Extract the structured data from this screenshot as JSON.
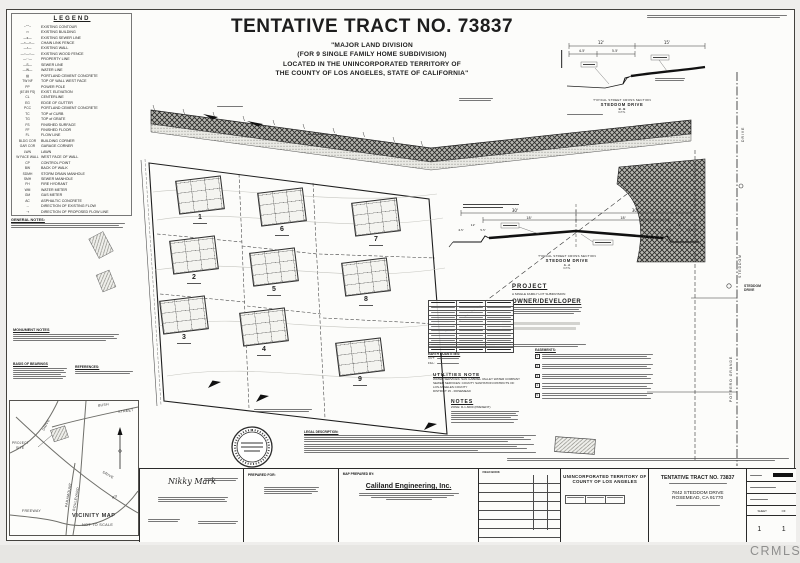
{
  "watermark": {
    "label": "CRMLS"
  },
  "header": {
    "title": "TENTATIVE TRACT NO. 73837",
    "sub1": "\"MAJOR LAND DIVISION",
    "sub2": "(FOR 9 SINGLE FAMILY HOME SUBDIVISION)",
    "sub3": "LOCATED IN THE UNINCORPORATED TERRITORY OF",
    "sub4": "THE COUNTY OF LOS ANGELES, STATE OF CALIFORNIA\""
  },
  "legend": {
    "heading": "LEGEND",
    "items": [
      {
        "sym": "~⌒~",
        "label": "EXISTING CONTOUR"
      },
      {
        "sym": "▭",
        "label": "EXISTING BUILDING"
      },
      {
        "sym": "—s—",
        "label": "EXISTING SEWER LINE"
      },
      {
        "sym": "—×—×—",
        "label": "CHAIN LINK FENCE"
      },
      {
        "sym": "—▪—",
        "label": "EXISTING WALL"
      },
      {
        "sym": "—○—○—",
        "label": "EXISTING WOOD FENCE"
      },
      {
        "sym": "—··—",
        "label": "PROPERTY LINE"
      },
      {
        "sym": "—S—",
        "label": "SEWER LINE"
      },
      {
        "sym": "—W—",
        "label": "WATER LINE"
      },
      {
        "sym": "▨",
        "label": "PORTLAND CEMENT CONCRETE"
      },
      {
        "sym": "TW NF",
        "label": "TOP OF WALL WEST FACE"
      },
      {
        "sym": "PP",
        "label": "POWER POLE"
      },
      {
        "sym": "(67.89 FS)",
        "label": "EXIST. ELEVATION"
      },
      {
        "sym": "CL",
        "label": "CENTERLINE"
      },
      {
        "sym": "EG",
        "label": "EDGE OF GUTTER"
      },
      {
        "sym": "PCC",
        "label": "PORTLAND CEMENT CONCRETE"
      },
      {
        "sym": "TC",
        "label": "TOP of CURB"
      },
      {
        "sym": "TG",
        "label": "TOP of GRATE"
      },
      {
        "sym": "FS",
        "label": "FINISHED SURFACE"
      },
      {
        "sym": "FF",
        "label": "FINISHED FLOOR"
      },
      {
        "sym": "FL",
        "label": "FLOW LINE"
      },
      {
        "sym": "BLDG COR",
        "label": "BUILDING CORNER"
      },
      {
        "sym": "GAR COR",
        "label": "GARAGE CORNER"
      },
      {
        "sym": "LWN",
        "label": "LAWN"
      },
      {
        "sym": "W FACE WALL",
        "label": "WEST FACE OF WALL"
      },
      {
        "sym": "CP",
        "label": "CONTROL POINT"
      },
      {
        "sym": "BW",
        "label": "BACK OF WALK"
      },
      {
        "sym": "SDMH",
        "label": "STORM DRAIN MANHOLE"
      },
      {
        "sym": "SMH",
        "label": "SEWER MANHOLE"
      },
      {
        "sym": "FH",
        "label": "FIRE HYDRANT"
      },
      {
        "sym": "WM",
        "label": "WATER METER"
      },
      {
        "sym": "GM",
        "label": "GAS METER"
      },
      {
        "sym": "AC",
        "label": "ASPHALTIC CONCRETE"
      },
      {
        "sym": "→",
        "label": "DIRECTION OF EXISTING FLOW"
      },
      {
        "sym": "⇢",
        "label": "DIRECTION OF PROPOSED FLOW LINE"
      }
    ]
  },
  "left_notes": {
    "general": "GENERAL NOTES:",
    "monument": "MONUMENT NOTES",
    "basis": "BASIS OF BEARINGS",
    "references": "REFERENCES:"
  },
  "vicinity": {
    "title": "VICINITY MAP",
    "scale": "NOT TO SCALE",
    "bush": "BUSH",
    "street": "STREET",
    "drive_top": "DRIVE",
    "drive_mid": "DRIVE",
    "paramount": "PARAMOUNT",
    "boulevard": "BOULEVARD",
    "rd": "RD",
    "freeway": "FREEWAY",
    "site1": "PROJECT",
    "site2": "SITE"
  },
  "map": {
    "lots": [
      "1",
      "6",
      "7",
      "2",
      "5",
      "8",
      "3",
      "4",
      "9"
    ],
    "street_right_top": "DRIVE",
    "street_right_mid": "STEDDOM",
    "street_right_label1": "STEDDOM",
    "street_right_label2": "DRIVE",
    "street_right_name": "POTRERO GRANDE"
  },
  "cross_b": {
    "caption1": "TYPICAL STREET CROSS SECTION",
    "caption2": "STEDDOM DRIVE",
    "caption3": "B - B",
    "caption4": "N.T.S.",
    "dims": [
      "15'",
      "12'",
      "4.5'",
      "5.5'"
    ]
  },
  "cross_a": {
    "caption1": "TYPICAL STREET CROSS SECTION",
    "caption2": "STEDDOM DRIVE",
    "caption3": "A - A",
    "caption4": "N.T.S.",
    "dims": [
      "30'",
      "30'",
      "18'",
      "18'",
      "12'",
      "4.5'",
      "5.5'",
      "12'",
      "4.5'",
      "5.5'"
    ]
  },
  "project": {
    "heading": "PROJECT",
    "desc": "A SINGLE FAMILY LOT SUBDIVISION",
    "owner_heading": "OWNER/DEVELOPER"
  },
  "lot_table": {
    "rows": [
      {},
      {},
      {},
      {},
      {},
      {},
      {},
      {},
      {}
    ]
  },
  "earth": {
    "heading": "EARTH QUANTITIES:",
    "cut": "CUT:",
    "fill": "FILL:"
  },
  "utilities": {
    "heading": "UTILITIES NOTE",
    "l1": "WATER SERVICES: SAN GABRIEL VALLEY WATER COMPANY",
    "l2": "SEWER SERVICES: COUNTY SANITATION DISTRICTS OF",
    "l3": "LOS ANGELES COUNTY",
    "l4": "DISTRICT 15 - ROSEMEAD"
  },
  "notes": {
    "heading": "NOTES",
    "l1": "ZONE: R-1-6000 (PRESENT)"
  },
  "easements": {
    "heading": "EASEMENTS:",
    "items": [
      {
        "n": "1"
      },
      {
        "n": "2"
      },
      {
        "n": "3"
      },
      {
        "n": "4"
      },
      {
        "n": "5"
      }
    ]
  },
  "legal": {
    "heading": "LEGAL DESCRIPTION:"
  },
  "titleblock": {
    "signature": "Nikky Mark",
    "prepared_for": "PREPARED FOR:",
    "map_prepared_by": "MAP PREPARED BY:",
    "firm": "Caliland Engineering, Inc.",
    "field_book": "FIELD BOOK",
    "territory1": "UNINCORPORATED TERRITORY OF",
    "territory2": "COUNTY OF LOS ANGELES",
    "tract": "TENTATIVE TRACT NO. 73837",
    "address1": "7842 STEDDOM DRIVE",
    "address2": "ROSEMEAD, CA 91770",
    "sheet_label": "SHEET",
    "of_label": "OF",
    "sheet_no": "1",
    "sheet_total": "1"
  }
}
